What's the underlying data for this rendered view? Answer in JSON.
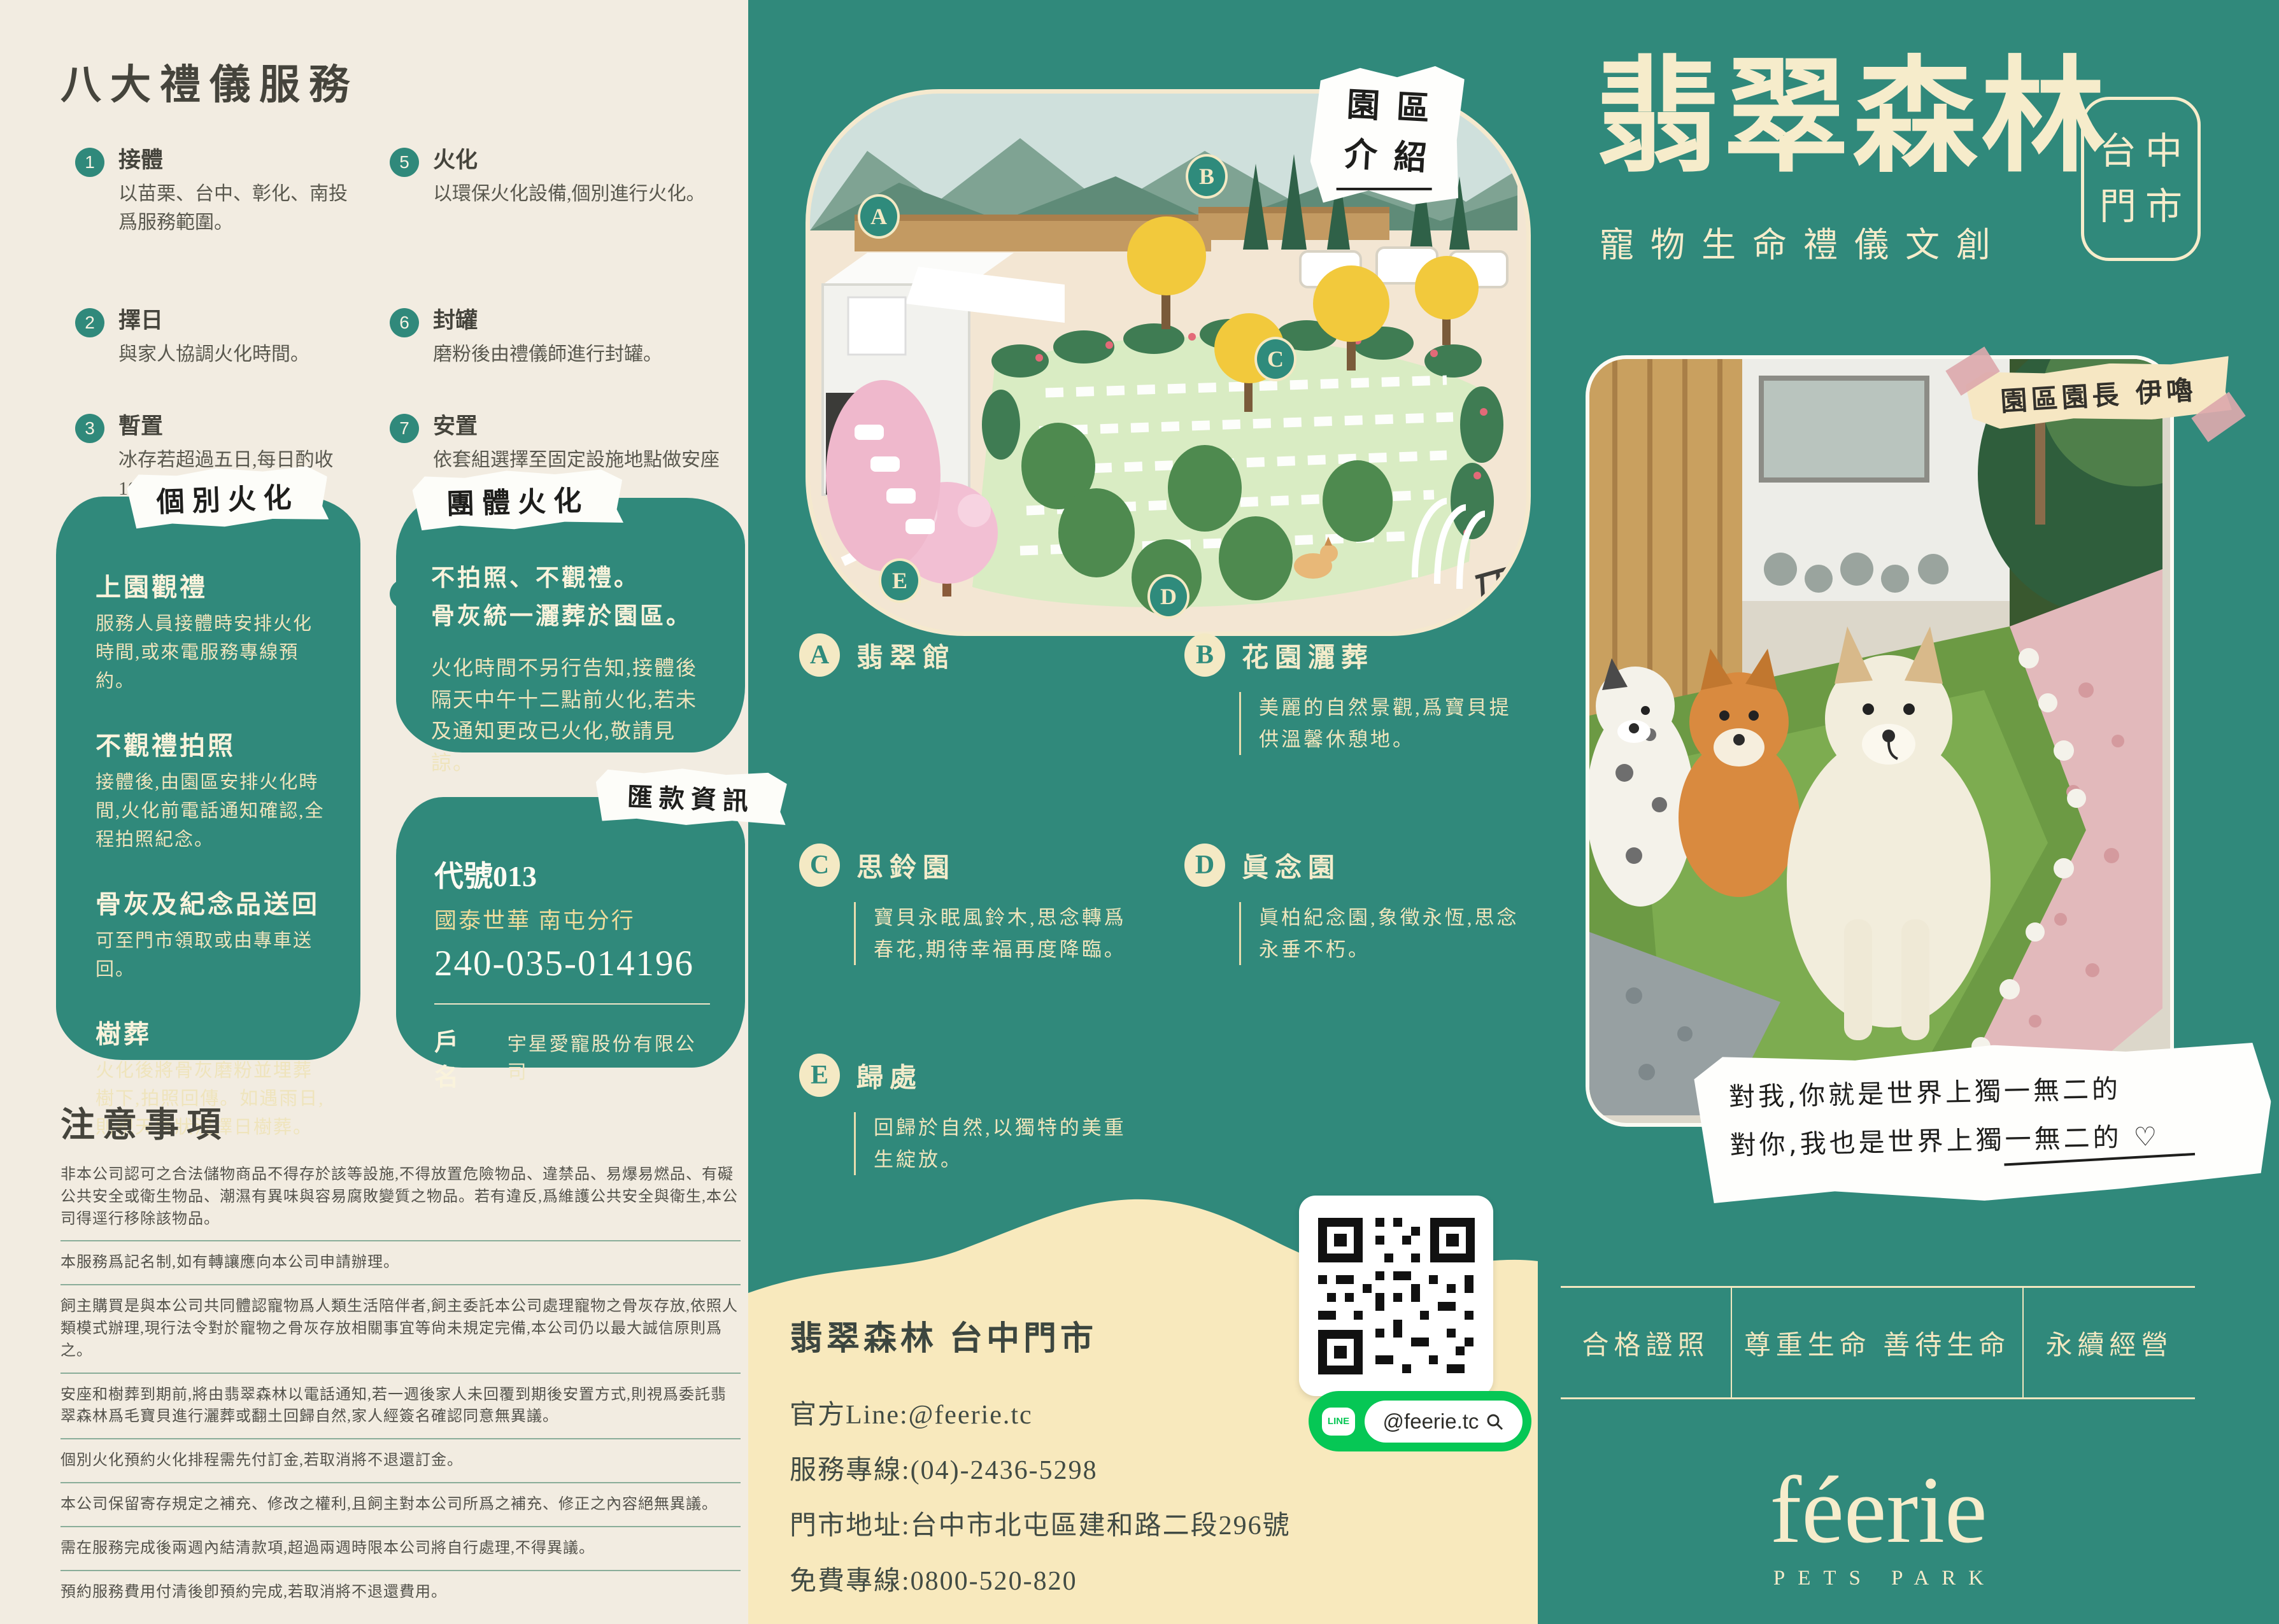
{
  "colors": {
    "teal": "#30897B",
    "cream": "#F2ECE1",
    "wave": "#F8E9BD",
    "line_green": "#06C755"
  },
  "left": {
    "services_title": "八大禮儀服務",
    "services": [
      {
        "num": "1",
        "title": "接體",
        "desc": "以苗栗、台中、彰化、南投爲服務範圍。"
      },
      {
        "num": "2",
        "title": "擇日",
        "desc": "與家人協調火化時間。"
      },
      {
        "num": "3",
        "title": "暫置",
        "desc": "冰存若超過五日,每日酌收100元冰存費。"
      },
      {
        "num": "4",
        "title": "告別",
        "desc": "依家人宗教信仰選擇儀式流程。"
      },
      {
        "num": "5",
        "title": "火化",
        "desc": "以環保火化設備,個別進行火化。"
      },
      {
        "num": "6",
        "title": "封罐",
        "desc": "磨粉後由禮儀師進行封罐。"
      },
      {
        "num": "7",
        "title": "安置",
        "desc": "依套組選擇至固定設施地點做安座或樹葬、灑葬。"
      },
      {
        "num": "8",
        "title": "追思",
        "desc": "配合家人需求策劃及舉辦追思會。(選購)"
      }
    ],
    "individual": {
      "tag": "個別火化",
      "items": [
        {
          "title": "上園觀禮",
          "desc": "服務人員接體時安排火化時間,或來電服務專線預約。"
        },
        {
          "title": "不觀禮拍照",
          "desc": "接體後,由園區安排火化時間,火化前電話通知確認,全程拍照紀念。"
        },
        {
          "title": "骨灰及紀念品送回",
          "desc": "可至門市領取或由專車送回。"
        },
        {
          "title": "樹葬",
          "desc": "火化後將骨灰磨粉並埋葬樹下,拍照回傳。如遇雨日,則視天氣狀況擇日樹葬。"
        }
      ]
    },
    "group": {
      "tag": "團體火化",
      "bold1": "不拍照、不觀禮。",
      "bold2": "骨灰統一灑葬於園區。",
      "body": "火化時間不另行告知,接體後隔天中午十二點前火化,若未及通知更改已火化,敬請見諒。"
    },
    "remit": {
      "tag": "匯款資訊",
      "code": "代號013",
      "bank": "國泰世華 南屯分行",
      "account": "240-035-014196",
      "holder_label": "戶名",
      "holder": "宇星愛寵股份有限公司"
    },
    "notes_title": "注意事項",
    "notes": [
      "非本公司認可之合法儲物商品不得存於該等設施,不得放置危險物品、違禁品、易爆易燃品、有礙公共安全或衛生物品、潮濕有異味與容易腐敗變質之物品。若有違反,爲維護公共安全與衛生,本公司得逕行移除該物品。",
      "本服務爲記名制,如有轉讓應向本公司申請辦理。",
      "飼主購買是與本公司共同體認寵物爲人類生活陪伴者,飼主委託本公司處理寵物之骨灰存放,依照人類模式辦理,現行法令對於寵物之骨灰存放相關事宜等尙未規定完備,本公司仍以最大誠信原則爲之。",
      "安座和樹葬到期前,將由翡翠森林以電話通知,若一週後家人未回覆到期後安置方式,則視爲委託翡翠森林爲毛寶貝進行灑葬或翻土回歸自然,家人經簽名確認同意無異議。",
      "個別火化預約火化排程需先付訂金,若取消將不退還訂金。",
      "本公司保留寄存規定之補充、修改之權利,且飼主對本公司所爲之補充、修正之內容絕無異議。",
      "需在服務完成後兩週內結清款項,超過兩週時限本公司將自行處理,不得異議。",
      "預約服務費用付清後卽預約完成,若取消將不退還費用。"
    ]
  },
  "map": {
    "note1": "園區",
    "note2": "介紹",
    "markers": [
      "A",
      "B",
      "C",
      "D",
      "E"
    ]
  },
  "areas": [
    {
      "letter": "A",
      "name": "翡翠館",
      "desc": ""
    },
    {
      "letter": "B",
      "name": "花園灑葬",
      "desc": "美麗的自然景觀,爲寶貝提供溫馨休憩地。"
    },
    {
      "letter": "C",
      "name": "思鈴園",
      "desc": "寶貝永眠風鈴木,思念轉爲春花,期待幸福再度降臨。"
    },
    {
      "letter": "D",
      "name": "眞念園",
      "desc": "眞柏紀念園,象徵永恆,思念永垂不朽。"
    },
    {
      "letter": "E",
      "name": "歸處",
      "desc": "回歸於自然,以獨特的美重生綻放。"
    }
  ],
  "contact": {
    "title": "翡翠森林 台中門市",
    "line": "官方Line:@feerie.tc",
    "phone": "服務專線:(04)-2436-5298",
    "address": "門市地址:台中市北屯區建和路二段296號",
    "tollfree": "免費專線:0800-520-820",
    "line_badge": "@feerie.tc",
    "line_icon_text": "LINE"
  },
  "right": {
    "title": "翡翠森林",
    "subtitle": "寵物生命禮儀文創",
    "badge_line1": "台中",
    "badge_line2": "門市",
    "keeper_label": "園區園長 伊嚕",
    "quote1": "對我,你就是世界上獨一無二的",
    "quote2": "對你,我也是世界上獨一無二的 ♡",
    "certs": [
      "合格證照",
      "尊重生命 善待生命",
      "永續經營"
    ]
  },
  "brand": {
    "logo": "féerie",
    "logo_sub": "PETS PARK"
  }
}
